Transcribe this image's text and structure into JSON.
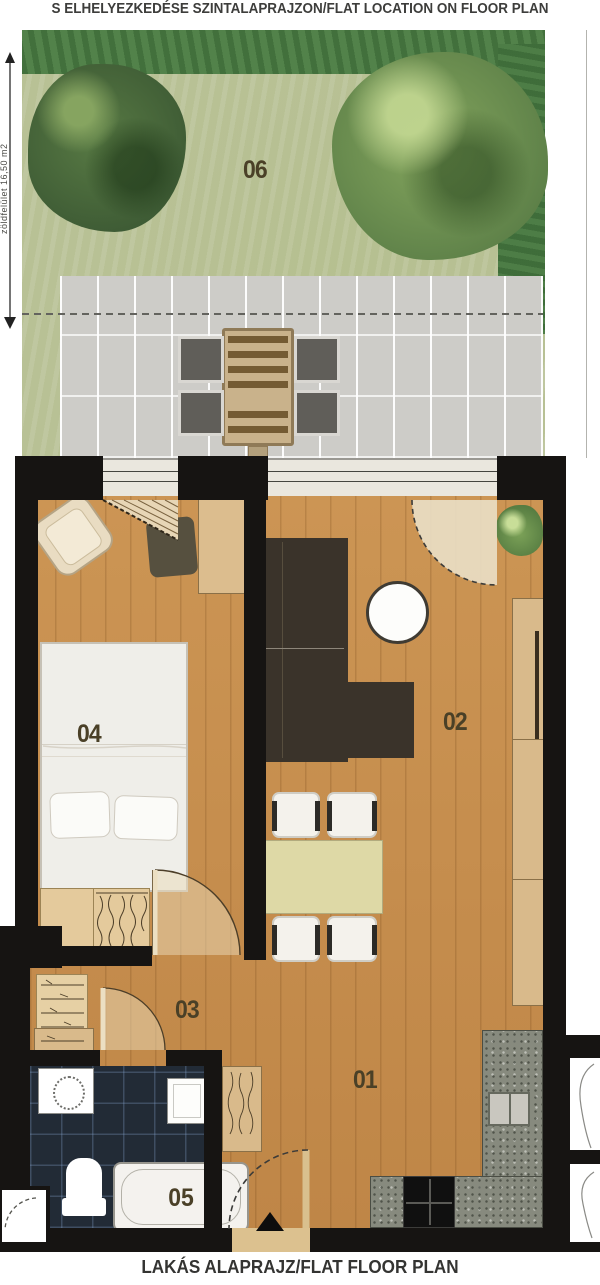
{
  "header": {
    "title": "S ELHELYEZKEDÉSE SZINTALAPRAJZON/FLAT LOCATION ON FLOOR PLAN"
  },
  "footer": {
    "title": "LAKÁS ALAPRAJZ/FLAT FLOOR PLAN"
  },
  "garden": {
    "dimension_label": "zöldfelület 16,50 m2"
  },
  "rooms": {
    "kitchen_entry": {
      "label": "01"
    },
    "living_room": {
      "label": "02"
    },
    "hall": {
      "label": "03"
    },
    "bedroom": {
      "label": "04"
    },
    "bathroom": {
      "label": "05"
    },
    "garden": {
      "label": "06"
    }
  },
  "colors": {
    "floor_wood": "#c78e4f",
    "wall": "#161412",
    "terrace": "#cdccc8",
    "grass": "#b8c195",
    "hedge": "#52824a",
    "bathroom_floor": "#222b36",
    "counter": "#878a7e",
    "dining_table": "#ded9a6",
    "sofa": "#3a332a",
    "label_text": "#4a4027"
  }
}
